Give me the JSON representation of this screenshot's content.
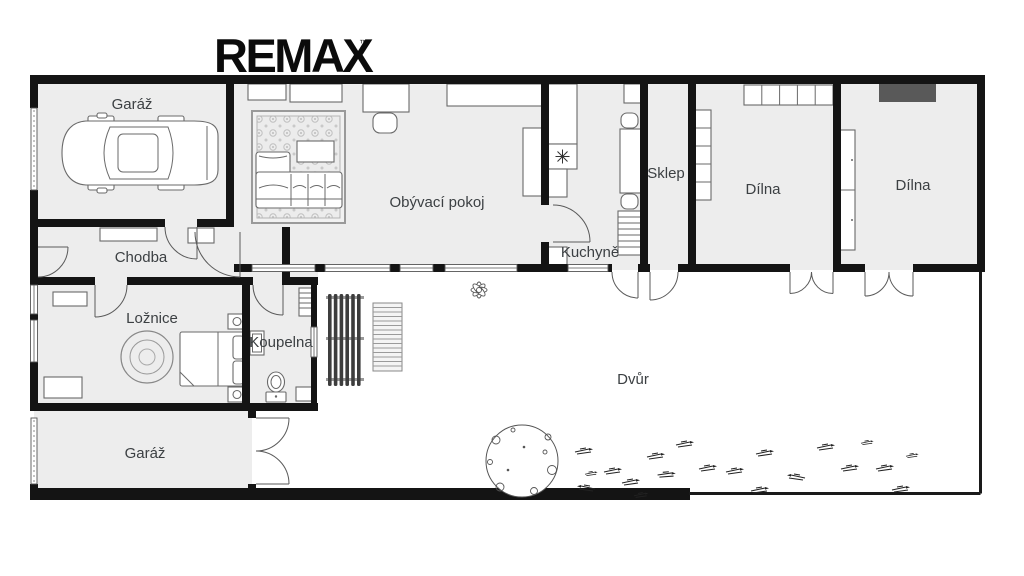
{
  "logo": {
    "text": "REMAX",
    "trademark": "™"
  },
  "rooms": {
    "garage_top": {
      "label": "Garáž"
    },
    "living_room": {
      "label": "Obývací pokoj"
    },
    "kitchen": {
      "label": "Kuchyně"
    },
    "cellar": {
      "label": "Sklep"
    },
    "workshop_left": {
      "label": "Dílna"
    },
    "workshop_right": {
      "label": "Dílna"
    },
    "hallway": {
      "label": "Chodba"
    },
    "bedroom": {
      "label": "Ložnice"
    },
    "bathroom": {
      "label": "Koupelna"
    },
    "garage_bottom": {
      "label": "Garáž"
    },
    "courtyard": {
      "label": "Dvůr"
    }
  },
  "colors": {
    "wall": "#141414",
    "room_fill": "#ededed",
    "label": "#3c4043",
    "workbench": "#595959",
    "screen_slats": "#3d3d3d"
  }
}
